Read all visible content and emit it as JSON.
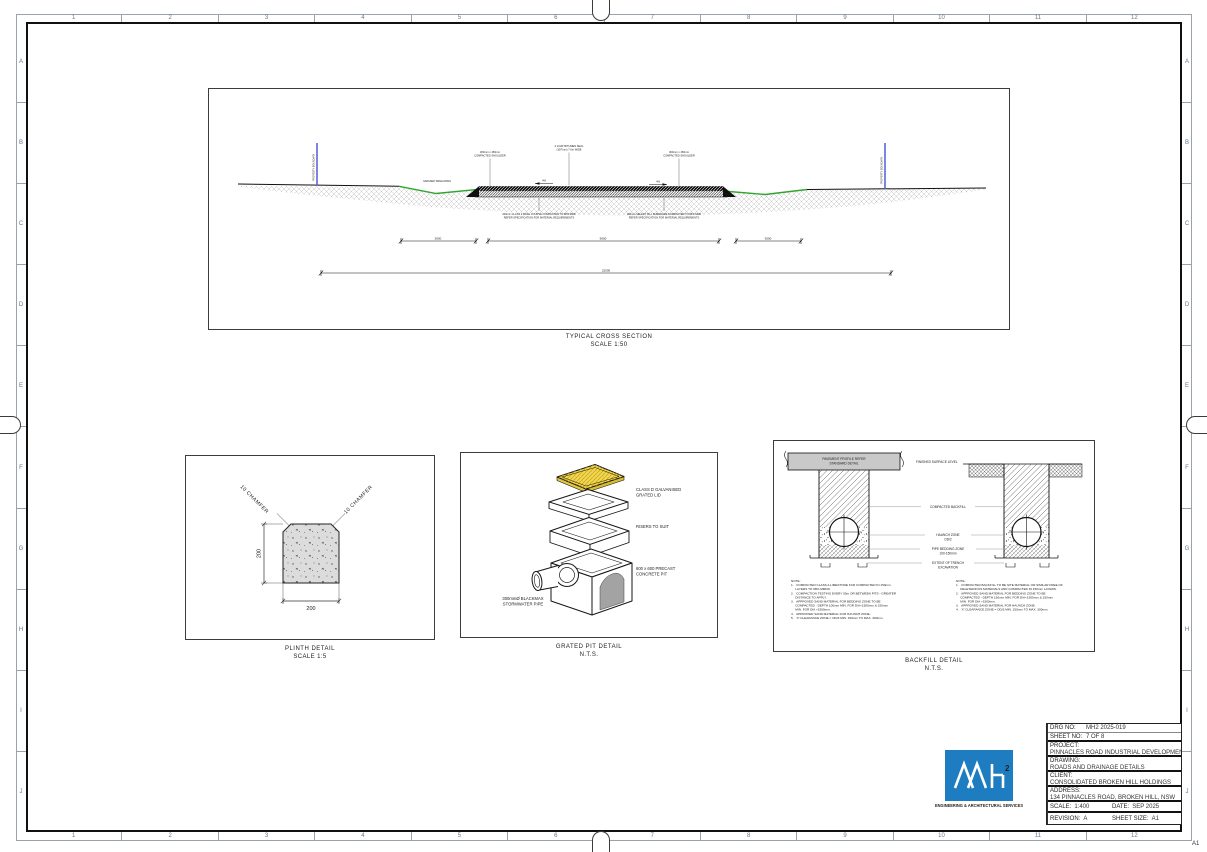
{
  "sheet": {
    "grid_columns": [
      "1",
      "2",
      "3",
      "4",
      "5",
      "6",
      "7",
      "8",
      "9",
      "10",
      "11",
      "12"
    ],
    "grid_rows": [
      "A",
      "B",
      "C",
      "D",
      "E",
      "F",
      "G",
      "H",
      "I",
      "J"
    ],
    "corner_label": "A1"
  },
  "cross_section": {
    "title": "TYPICAL CROSS SECTION",
    "scale": "SCALE 1:50",
    "boundary_label_left": "PROPERTY BOUNDARY",
    "boundary_label_right": "PROPERTY BOUNDARY",
    "label_shoulder_left_1": "300mm x 150mm",
    "label_shoulder_left_2": "COMPACTED SHOULDER",
    "label_seal_1": "2 COAT BITUMEN SEAL",
    "label_seal_2": "(10/7mm) 7.0m WIDE",
    "label_shoulder_right_1": "300mm x 150mm",
    "label_shoulder_right_2": "COMPACTED SHOULDER",
    "label_drain": "GRASSED TABLE DRAIN",
    "crossfall_left": "4%",
    "crossfall_right": "4%",
    "label_base_1": "200mm CLASS 2 BASE COURSE COMPACTED TO 98% MDD",
    "label_base_2": "REFER SPECIFICATION FOR MATERIAL REQUIREMENTS",
    "label_subgrade_1": "300mm SELECT FILL SUBGRADE COMPACTED TO 95% MDD",
    "label_subgrade_2": "REFER SPECIFICATION FOR MATERIAL REQUIREMENTS",
    "dim_left": "3000",
    "dim_centre": "9000",
    "dim_right": "3000",
    "dim_overall": "22000"
  },
  "plinth": {
    "title": "PLINTH DETAIL",
    "scale": "SCALE 1:5",
    "chamfer_label_left": "10 CHAMFER",
    "chamfer_label_right": "10 CHAMFER",
    "dim_width": "200",
    "dim_height": "200"
  },
  "grated_pit": {
    "title": "GRATED PIT DETAIL",
    "scale": "N.T.S.",
    "lid_label_1": "CLASS D GALVANISED",
    "lid_label_2": "GRATED LID",
    "riser_label": "RISERS TO SUIT",
    "pit_label_1": "600 x 600 PRECAST",
    "pit_label_2": "CONCRETE PIT",
    "pipe_label_1": "300mmØ BLACKMAX",
    "pipe_label_2": "STORMWATER PIPE"
  },
  "backfill": {
    "title": "BACKFILL DETAIL",
    "scale": "N.T.S.",
    "pavement_label_1": "PAVEMENT PROFILE REFER",
    "pavement_label_2": "STANDARD DETAIL",
    "surface_label": "FINISHED SURFACE LEVEL",
    "zone_backfill": "COMPACTED BACKFILL",
    "zone_haunch_1": "HAUNCH ZONE",
    "zone_haunch_2": "OD/2",
    "zone_bedding_1": "PIPE BEDDING ZONE",
    "zone_bedding_2": "100-150mm",
    "zone_extent_1": "EXTENT OF TRENCH",
    "zone_extent_2": "EXCAVATION",
    "notes_left": [
      "NOTE:",
      "1.   COMPACTED CLASS A LIMESTONE FCR COMPACTED IN 150mm",
      "     LAYERS TO 98% MMDD.",
      "2.   COMPACTION TESTING EVERY 50m OR BETWEEN PITS - GREATER",
      "     DISTANCE TO APPLY.",
      "3.   APPROVED SAND MATERIAL FOR BEDDING ZONE TO BE",
      "     COMPACTED - DEPTH 100mm MIN. FOR DIA<1500mm & 150mm",
      "     MIN. FOR DIA >1500mm.",
      "4.   APPROVED SAND MATERIAL FOR HAUNCH ZONE.",
      "5.   'X' CLEARANCE ZONE = OD/3 MIN. 150mm TO MAX. 300mm"
    ],
    "notes_right": [
      "NOTE:",
      "1.   COMPACTED BACKFILL TO BE SITE MATERIAL OR SIMILAR FREE OF",
      "     DELETERIOUS MATERIALS AND COMPACTED IN 150mm LAYERS.",
      "2.   APPROVED SAND MATERIAL FOR BEDDING ZONE TO BE",
      "     COMPACTED - DEPTH 150mm MIN. FOR DIA<1500mm & 150mm",
      "     MIN. FOR DIA >1500mm.",
      "3.   APPROVED SAND MATERIAL FOR HAUNCH ZONE.",
      "4.   'X' CLEARANCE ZONE = OD/3 MIN. 150mm TO MAX. 300mm"
    ]
  },
  "title_block": {
    "issue_label": "DESIGN ISSUE",
    "drg_no_label": "DRG NO:",
    "drg_no": "MH2 2025-019",
    "sheet_no_label": "SHEET NO:",
    "sheet_no": "7 OF 8",
    "project_label": "PROJECT:",
    "project": "PINNACLES ROAD INDUSTRIAL DEVELOPMENT",
    "drawing_label": "DRAWING:",
    "drawing": "ROADS AND DRAINAGE DETAILS",
    "client_label": "CLIENT:",
    "client": "CONSOLIDATED BROKEN HILL HOLDINGS",
    "address_label": "ADDRESS:",
    "address": "134 PINNACLES ROAD, BROKEN HILL, NSW",
    "scale_label": "SCALE:",
    "scale": "1:400",
    "date_label": "DATE:",
    "date": "SEP 2025",
    "revision_label": "REVISION:",
    "revision": "A",
    "sheet_size_label": "SHEET SIZE:",
    "sheet_size": "A1"
  },
  "logo": {
    "mark_sup": "2",
    "caption": "ENGINEERING & ARCHITECTURAL SERVICES",
    "brand_blue": "#1e7dc1"
  }
}
